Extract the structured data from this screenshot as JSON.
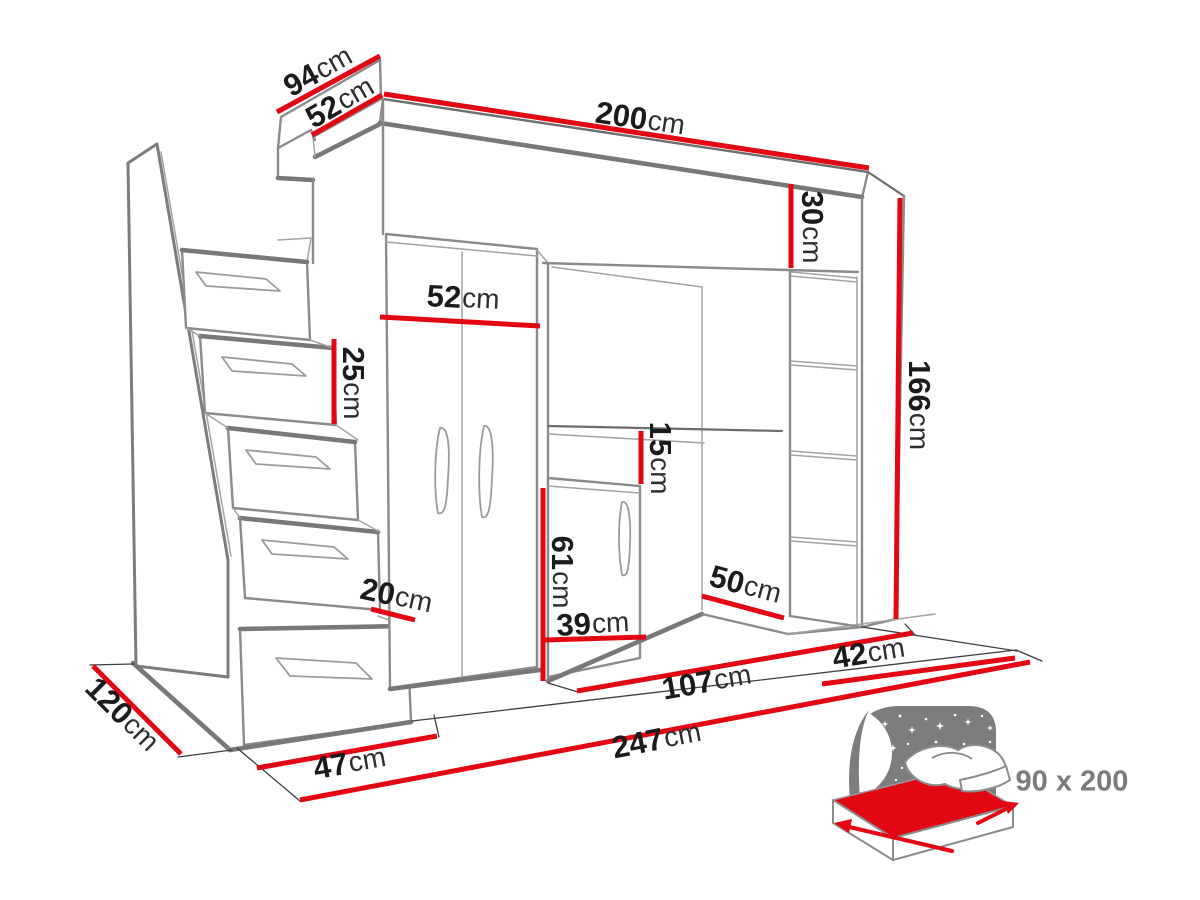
{
  "diagram_title": "loft bed dimensions drawing",
  "dimensions": {
    "d94": {
      "value": "94",
      "unit": "cm"
    },
    "d52_top": {
      "value": "52",
      "unit": "cm"
    },
    "d200": {
      "value": "200",
      "unit": "cm"
    },
    "d30": {
      "value": "30",
      "unit": "cm"
    },
    "d166": {
      "value": "166",
      "unit": "cm"
    },
    "d52_wardrobe": {
      "value": "52",
      "unit": "cm"
    },
    "d25": {
      "value": "25",
      "unit": "cm"
    },
    "d15": {
      "value": "15",
      "unit": "cm"
    },
    "d61": {
      "value": "61",
      "unit": "cm"
    },
    "d39": {
      "value": "39",
      "unit": "cm"
    },
    "d50": {
      "value": "50",
      "unit": "cm"
    },
    "d20": {
      "value": "20",
      "unit": "cm"
    },
    "d47": {
      "value": "47",
      "unit": "cm"
    },
    "d120": {
      "value": "120",
      "unit": "cm"
    },
    "d107": {
      "value": "107",
      "unit": "cm"
    },
    "d42": {
      "value": "42",
      "unit": "cm"
    },
    "d247": {
      "value": "247",
      "unit": "cm"
    }
  },
  "bed_icon": {
    "size_label": "90 x 200"
  },
  "colors": {
    "dimension_red": "#e30613",
    "furniture_line_gray": "#8b8b8b",
    "label_text": "#1b1b1b",
    "icon_gray": "#7d7d7d"
  }
}
